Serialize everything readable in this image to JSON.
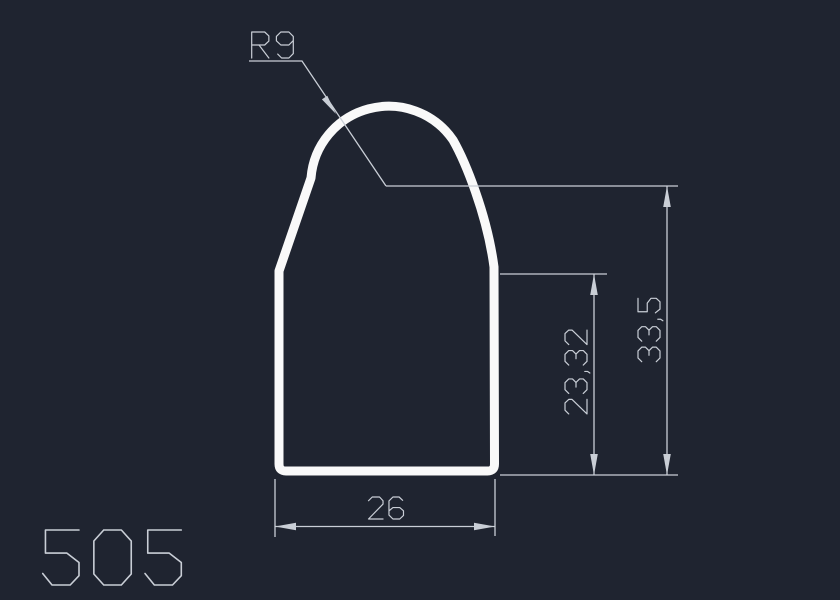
{
  "canvas": {
    "background_color": "#1f2430",
    "profile_color": "#f9f9f9",
    "dimension_color": "#c9ced6"
  },
  "drawing": {
    "number": "505",
    "dimensions": {
      "radius": {
        "label": "R9"
      },
      "overall_height": {
        "label": "33,5"
      },
      "body_height": {
        "label": "23,32"
      },
      "width": {
        "label": "26"
      }
    }
  }
}
